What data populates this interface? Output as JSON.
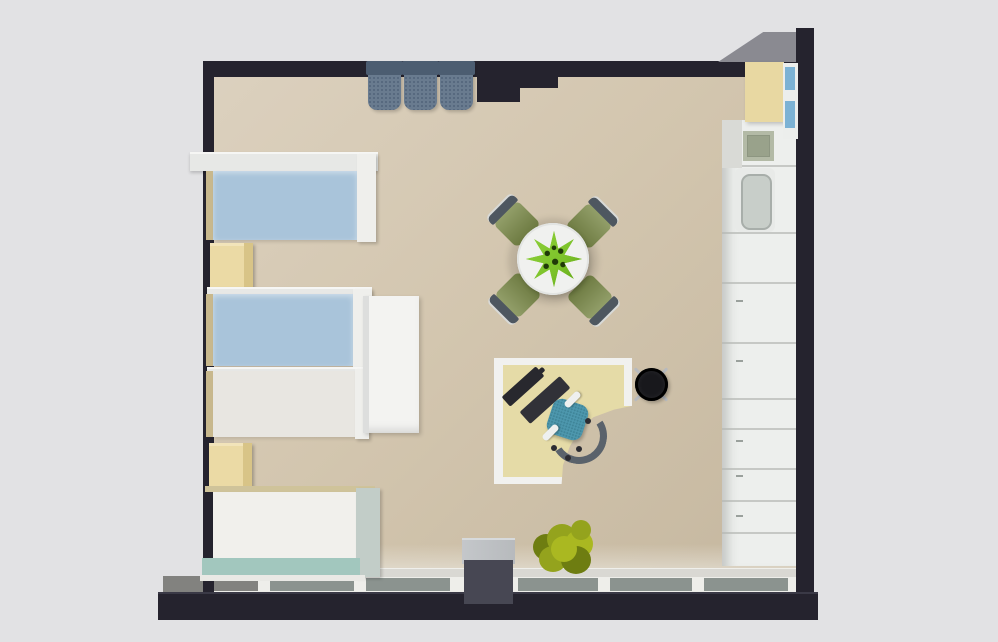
{
  "scene": {
    "title": "3D top-down floor plan render of a studio room with four single beds, dining table, corner desk and kitchenette",
    "view": "top-down 3D render",
    "counts": {
      "beds": 4,
      "nightstands": 2,
      "dining_chairs": 4,
      "wall_chairs": 3,
      "window_panes": 6
    }
  },
  "palette": {
    "canvas_bg": "#e2e2e4",
    "wall_dark": "#25232e",
    "wall_face": "#8a8a91",
    "floor_light": "#dcd1bf",
    "floor_mid": "#d3c6af",
    "floor_dark": "#c5b79f",
    "sill_light": "#d9d8d3",
    "window_pane": "#8b938f",
    "mullion_white": "#eeeeea",
    "slab_gray": "#82827f",
    "bed_blue": "#a9c4da",
    "mattress_gray": "#e8e6e1",
    "bed4_white": "#f1f0ec",
    "frame_white": "#efefec",
    "canopy_white": "#e7e8e6",
    "head_tan": "#c8b88d",
    "teal_blanket": "#a2c7be",
    "nightstand_cream": "#ebdaa5",
    "nightstand_side": "#d8c487",
    "wardrobe_white": "#f3f3f1",
    "top_chair_gray": "#697b8f",
    "top_chair_flap": "#4c5d71",
    "table_white": "#f0f1ef",
    "chair_olive": "#7b8a49",
    "chair_back": "#4e5760",
    "plant_green": "#7cc22a",
    "plant_dot": "#203a08",
    "desk_cream": "#e5dba7",
    "desk_edge": "#f1f1ef",
    "device_dark": "#28282e",
    "office_chair_teal": "#4d97ad",
    "office_back": "#5a626b",
    "stool_black": "#18181c",
    "metal": "#b7babe",
    "kitchen_white": "#edefed",
    "kitchen_yellow": "#e8d8a2",
    "hob_green": "#99a28b",
    "basin_gray": "#c8cec9",
    "shelf_blue": "#7cb2d4",
    "pillar_top": "#b7babd",
    "pillar_body": "#474753",
    "bush_green": "#94a31d",
    "bush_light": "#aab821",
    "bush_dark": "#6e7d11"
  },
  "furniture": [
    {
      "name": "single-bed-1",
      "finish": "blue mattress, white canopy frame"
    },
    {
      "name": "single-bed-2",
      "finish": "blue mattress, white frame"
    },
    {
      "name": "single-bed-3",
      "finish": "light gray mattress, white frame"
    },
    {
      "name": "single-bed-4",
      "finish": "white mattress, teal blanket"
    },
    {
      "name": "nightstand-1",
      "finish": "cream"
    },
    {
      "name": "nightstand-2",
      "finish": "cream"
    },
    {
      "name": "wardrobe",
      "finish": "white"
    },
    {
      "name": "dining-table",
      "finish": "round, white, green centerpiece plant"
    },
    {
      "name": "dining-chair",
      "finish": "olive green with gray backrest",
      "count": 4
    },
    {
      "name": "corner-desk",
      "finish": "cream with white edge, monitor and keyboard"
    },
    {
      "name": "office-chair",
      "finish": "teal seat, gray backrest"
    },
    {
      "name": "stool",
      "finish": "black with chrome legs"
    },
    {
      "name": "wall-chair",
      "finish": "gray folding chair on top wall",
      "count": 3
    },
    {
      "name": "kitchen-cabinet-run",
      "finish": "white"
    },
    {
      "name": "upper-cabinet",
      "finish": "pale yellow"
    },
    {
      "name": "cooktop",
      "finish": "green-gray"
    },
    {
      "name": "kitchen-sink",
      "finish": "gray basin"
    },
    {
      "name": "kitchen-shelf",
      "finish": "white with blue items"
    },
    {
      "name": "window-band",
      "finish": "bottom wall glazing with white mullions"
    },
    {
      "name": "pillar",
      "finish": "gray column at bottom wall"
    },
    {
      "name": "floor-plant",
      "finish": "yellow-green bush"
    }
  ]
}
